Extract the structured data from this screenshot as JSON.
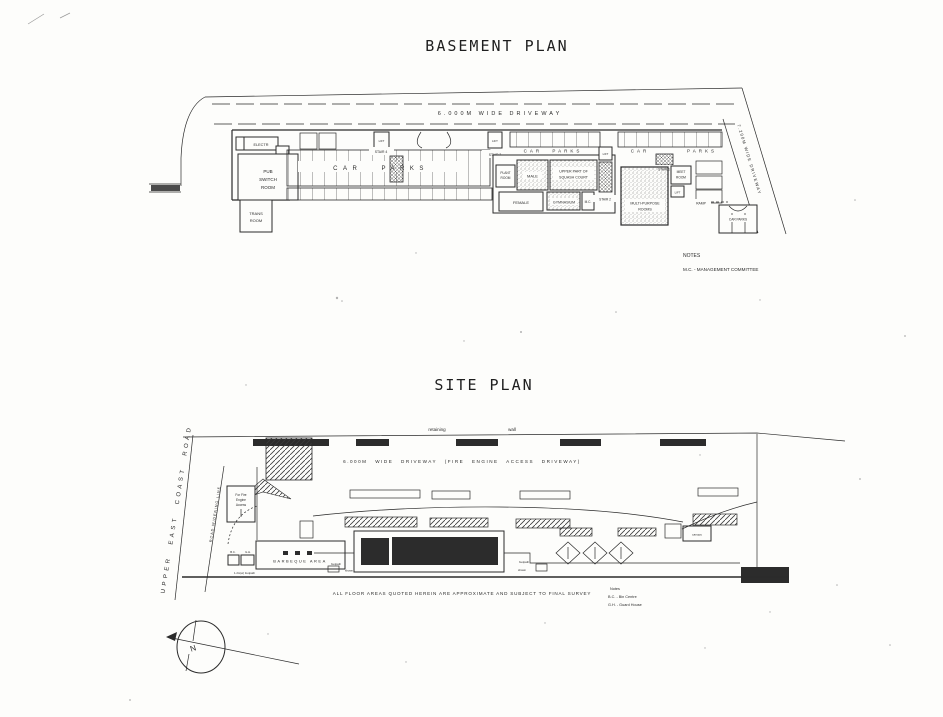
{
  "colors": {
    "ink": "#2b2b2b",
    "paper": "#fdfdfb",
    "dark_fill": "#2c2c2c"
  },
  "basement_plan": {
    "title": "BASEMENT PLAN",
    "driveway_label": "6.000M WIDE DRIVEWAY",
    "side_driveway_label": "7.200M WIDE DRIVEWAY",
    "car_parks_left": "CAR PARKS",
    "car_parks_mid": "CAR PARKS",
    "car_right": "CAR",
    "parks_right": "PARKS",
    "rooms": {
      "electrical": "ELECTR",
      "pub_switch": [
        "PUB",
        "SWITCH",
        "ROOM"
      ],
      "transformer": [
        "TRANS",
        "ROOM"
      ],
      "plant": [
        "PLANT",
        "ROOM"
      ],
      "male": "MALE",
      "squash": [
        "UPPER PART OF",
        "SQUASH COURT"
      ],
      "female": "FEMALE",
      "gymnasium": "GYMNASIUM",
      "mc": "M.C.",
      "meeting": [
        "MEET",
        "ROOM"
      ],
      "multi_purpose": [
        "MULTI-PURPOSE",
        "ROOMS"
      ],
      "ramp": "RAMP",
      "car_parks_corner": "CAR PARKS"
    },
    "circulation": {
      "stair1": "STAIR 1",
      "stair2": "STAIR 2",
      "stair3": "STAIR 3",
      "stair4": "STAIR 4",
      "lift": "LIFT"
    },
    "notes": {
      "heading": "NOTES",
      "mc_definition": "M.C. - MANAGEMENT COMMITTEE"
    }
  },
  "site_plan": {
    "title": "SITE PLAN",
    "retaining_label": "retaining",
    "wall_label": "wall",
    "driveway_label": "6.000M WIDE DRIVEWAY (FIRE ENGINE ACCESS DRIVEWAY)",
    "road_name": "UPPER EAST COAST ROAD",
    "road_widening_label": "ROAD WIDENING LINE",
    "fire_engine_access": [
      "For Fire",
      "Engine",
      "Access"
    ],
    "barbeque_label": "BARBEQUE AREA",
    "canopy_label": "canopy",
    "footpath_word": "footpath",
    "shown_word": "shown",
    "entrance_footpath": "1.2m(w) footpath",
    "bin_centre_abbr": "B.C.",
    "guard_house_abbr": "G.H.",
    "survey_note": "ALL FLOOR AREAS QUOTED HEREIN ARE APPROXIMATE AND SUBJECT TO FINAL SURVEY",
    "legend": {
      "heading": "Notes",
      "bin_centre": "B.C. - Bin Centre",
      "guard_house": "G.H. - Guard House"
    },
    "compass_north": "N"
  }
}
